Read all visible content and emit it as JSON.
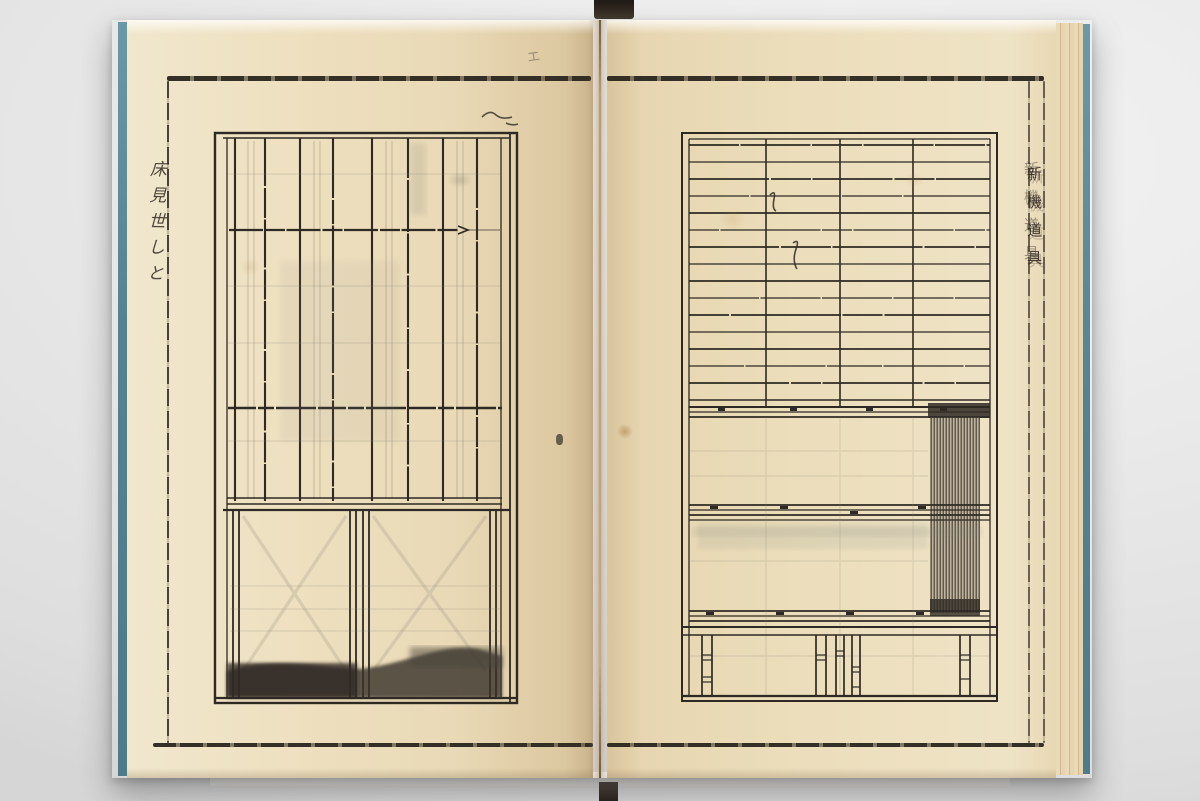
{
  "scene": {
    "backdrop_color": "#e9e9e9",
    "stand_strap_color": "#2b241d"
  },
  "book": {
    "page_color": "#ecdcba",
    "ink_color": "#2e2a23",
    "cover_edge_color": "#54828f",
    "left_page": {
      "margin_annotation": "床見世しと",
      "pencil_mark": "エ"
    },
    "right_page": {
      "title_column": "新機道具"
    }
  }
}
